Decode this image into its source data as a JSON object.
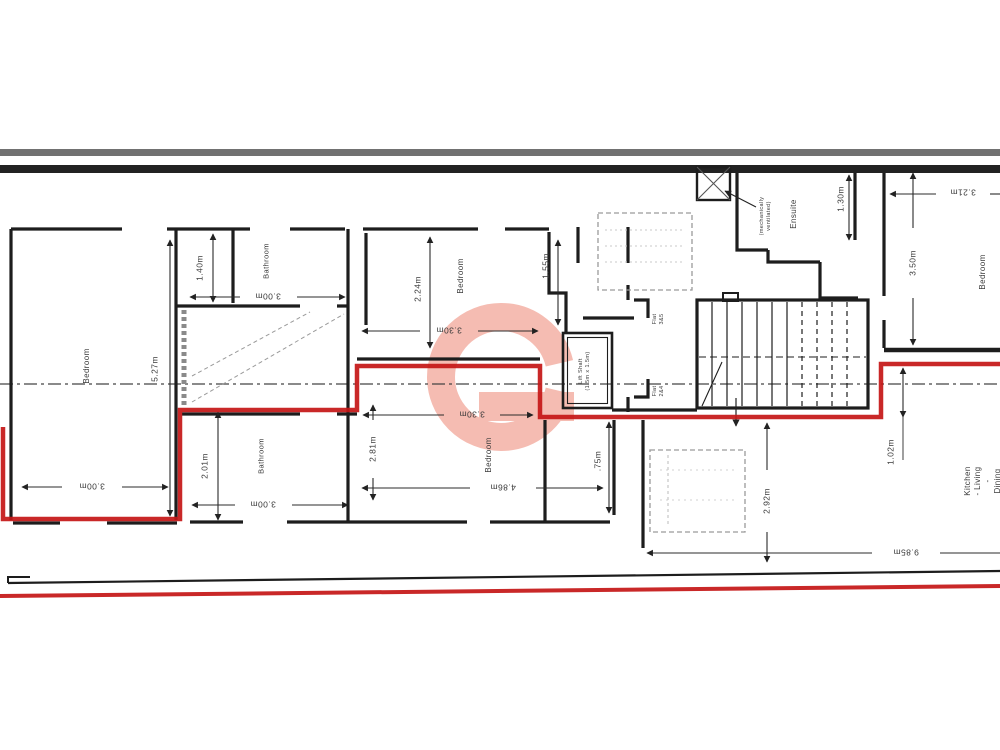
{
  "title": "Floor plan drawing with highlighted flat outline",
  "colors": {
    "highlight_outline": "#c41616",
    "watermark": "#f5bcb2",
    "wall": "#1d1d1d",
    "dim_text": "#3a3a3a"
  },
  "plan": {
    "rooms": [
      {
        "name": "room-label-bedroom-left",
        "text": "Bedroom",
        "x": 87,
        "y": 366,
        "rot": "ccw",
        "size": 8
      },
      {
        "name": "room-label-bathroom-upper",
        "text": "Bathroom",
        "x": 266,
        "y": 261,
        "rot": "ccw",
        "size": 7.5
      },
      {
        "name": "room-label-bedroom-mid-upper",
        "text": "Bedroom",
        "x": 461,
        "y": 276,
        "rot": "ccw",
        "size": 8
      },
      {
        "name": "room-label-bathroom-lower",
        "text": "Bathroom",
        "x": 261,
        "y": 456,
        "rot": "ccw",
        "size": 7.5
      },
      {
        "name": "room-label-bedroom-mid-lower",
        "text": "Bedroom",
        "x": 489,
        "y": 455,
        "rot": "ccw",
        "size": 8
      },
      {
        "name": "room-label-bedroom-right",
        "text": "Bedroom",
        "x": 983,
        "y": 272,
        "rot": "ccw",
        "size": 8
      },
      {
        "name": "room-label-ensuite",
        "text": "Ensuite",
        "x": 794,
        "y": 214,
        "rot": "ccw",
        "size": 8
      },
      {
        "name": "room-label-kitchen-living-dining",
        "text": "Kitchen - Living\n- Dining -",
        "x": 988,
        "y": 481,
        "rot": "ccw",
        "size": 8
      }
    ],
    "dimensions": [
      {
        "name": "dim-3-00m-left-room",
        "text": "3.00m",
        "x": 92,
        "y": 486,
        "rot": "flip",
        "size": 8.5
      },
      {
        "name": "dim-5-27m",
        "text": "5.27m",
        "x": 155,
        "y": 369,
        "rot": "ccw",
        "size": 8.5
      },
      {
        "name": "dim-1-40m",
        "text": "1.40m",
        "x": 200,
        "y": 268,
        "rot": "ccw",
        "size": 8.5
      },
      {
        "name": "dim-3-00m-bathroom-up",
        "text": "3.00m",
        "x": 268,
        "y": 296,
        "rot": "flip",
        "size": 8.5
      },
      {
        "name": "dim-2-01m",
        "text": "2.01m",
        "x": 205,
        "y": 466,
        "rot": "ccw",
        "size": 8.5
      },
      {
        "name": "dim-3-00m-bathroom-low",
        "text": "3.00m",
        "x": 263,
        "y": 504,
        "rot": "flip",
        "size": 8.5
      },
      {
        "name": "dim-2-24m",
        "text": "2.24m",
        "x": 418,
        "y": 289,
        "rot": "ccw",
        "size": 8.5
      },
      {
        "name": "dim-3-30m-upper",
        "text": "3.30m",
        "x": 449,
        "y": 330,
        "rot": "flip",
        "size": 8.5
      },
      {
        "name": "dim-2-81m",
        "text": "2.81m",
        "x": 373,
        "y": 449,
        "rot": "ccw",
        "size": 8.5
      },
      {
        "name": "dim-3-30m-lower",
        "text": "3.30m",
        "x": 472,
        "y": 414,
        "rot": "flip",
        "size": 8.5
      },
      {
        "name": "dim-4-86m",
        "text": "4.86m",
        "x": 503,
        "y": 487,
        "rot": "flip",
        "size": 8.5
      },
      {
        "name": "dim-1-55m",
        "text": "1.55m",
        "x": 546,
        "y": 266,
        "rot": "ccw",
        "size": 8.5
      },
      {
        "name": "dim-0-75m",
        "text": ".75m",
        "x": 598,
        "y": 461,
        "rot": "ccw",
        "size": 8.5
      },
      {
        "name": "dim-2-92m",
        "text": "2.92m",
        "x": 767,
        "y": 501,
        "rot": "ccw",
        "size": 8.5
      },
      {
        "name": "dim-1-02m",
        "text": "1.02m",
        "x": 891,
        "y": 452,
        "rot": "ccw",
        "size": 8.5
      },
      {
        "name": "dim-9-85m",
        "text": "9.85m",
        "x": 906,
        "y": 552,
        "rot": "flip",
        "size": 8.5
      },
      {
        "name": "dim-3-21m",
        "text": "3.21m",
        "x": 963,
        "y": 192,
        "rot": "flip",
        "size": 8.5
      },
      {
        "name": "dim-3-50m",
        "text": "3.50m",
        "x": 913,
        "y": 263,
        "rot": "ccw",
        "size": 8.5
      },
      {
        "name": "dim-1-30m",
        "text": "1.30m",
        "x": 841,
        "y": 199,
        "rot": "ccw",
        "size": 8.5
      }
    ],
    "annotations": [
      {
        "name": "lift-shaft-label",
        "text": "Lift Shaft\n(1.5m x 1.5m)",
        "x": 585,
        "y": 371,
        "rot": "ccw",
        "size": 5.5
      },
      {
        "name": "flat-3-5-label",
        "text": "Flat\n3&5",
        "x": 659,
        "y": 319,
        "rot": "ccw",
        "size": 5.5
      },
      {
        "name": "flat-2-4-label",
        "text": "Flat\n2&4",
        "x": 659,
        "y": 391,
        "rot": "ccw",
        "size": 5.5
      },
      {
        "name": "mech-vent-label",
        "text": "(mechanically\nventilated)",
        "x": 766,
        "y": 216,
        "rot": "ccw",
        "size": 5.5
      }
    ]
  }
}
